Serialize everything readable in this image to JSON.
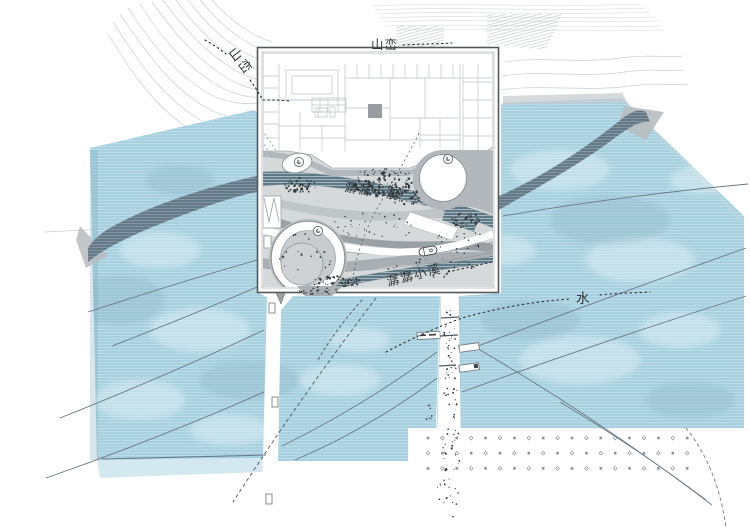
{
  "labels": {
    "mountain_diagonal": "山峦",
    "mountain_top": "山峦",
    "water": "水",
    "stream_upper": "潺潺小溪",
    "stream_lower": "潺潺小溪"
  },
  "colors": {
    "water": "#a7d1e0",
    "water_stripe": "#c6e2ec",
    "dark_band": "#5d7280",
    "teal_stream": "#5f7a87",
    "landscape_base": "#d6d9da",
    "panel_border": "#54585b",
    "building_line": "#bfc4c7",
    "flow_line": "#6a7a85",
    "contour_line": "#c9cdcf",
    "ink": "#2f3438",
    "grid_dot": "#8d949b"
  },
  "dot_grid": {
    "rows": 3,
    "cols": 19,
    "x0": 428,
    "y0": 438,
    "dx": 14.4,
    "dy": 15.2,
    "size": 2.6
  }
}
